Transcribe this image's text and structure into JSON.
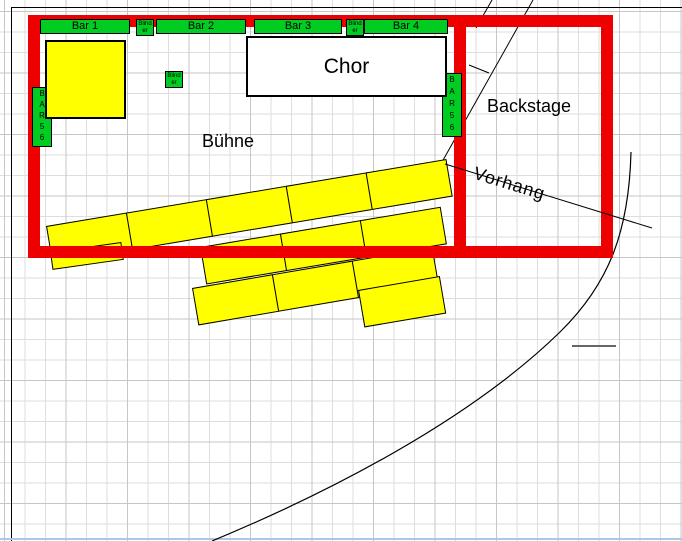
{
  "labels": {
    "stage": "Bühne",
    "backstage": "Backstage",
    "curtain": "Vorhang",
    "choir": "Chor"
  },
  "bars": [
    {
      "label": "Bar 1"
    },
    {
      "label": "Bar 2"
    },
    {
      "label": "Bar 3"
    },
    {
      "label": "Bar 4"
    }
  ],
  "blinder": {
    "line1": "Blind",
    "line2": "er"
  },
  "side_bar": {
    "letters": [
      "B",
      "A",
      "R",
      "5",
      "6"
    ]
  },
  "colors": {
    "wall_red": "#ee0000",
    "platform_yellow": "#ffff00",
    "bar_green": "#00cc22",
    "choir_white": "#ffffff",
    "grid_minor": "#dedede",
    "grid_major": "#c6c6c6",
    "window_edge_blue": "#abc8e8"
  }
}
